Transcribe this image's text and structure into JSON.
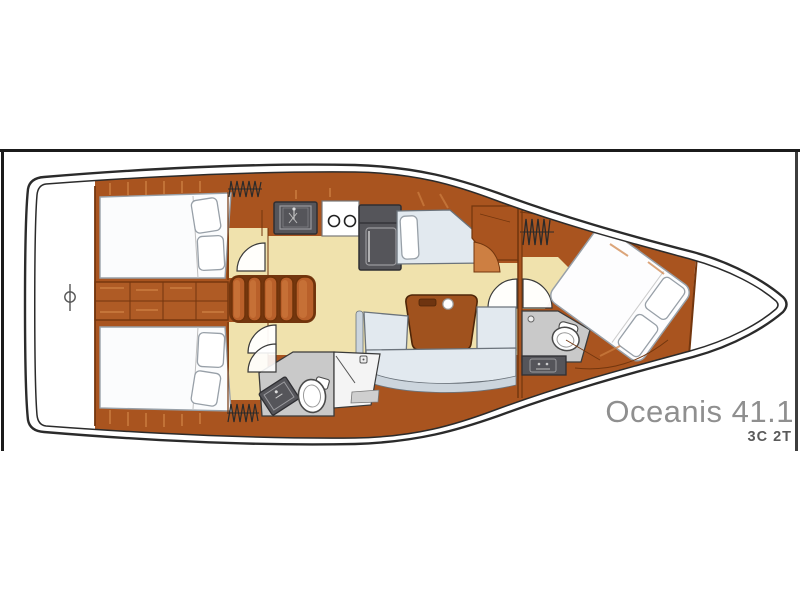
{
  "caption": {
    "title": "Oceanis 41.1",
    "variant": "3C 2T"
  },
  "colors": {
    "border": "#1b1b1b",
    "hullLine": "#2b2b2b",
    "wood": "#a9541f",
    "woodDark": "#73360e",
    "woodLight": "#cd7f42",
    "floor": "#f0e2ad",
    "gray": "#55555a",
    "grayDark": "#2f2f33",
    "grayLine": "#9a9a9e",
    "headFloor": "#c9c9c9",
    "settee": "#e2e9ef",
    "setteeBack": "#ccd5dd",
    "setteeLine": "#6b737b",
    "berth": "#fbfcfd",
    "berthLine": "#98a0a8",
    "table": "#a0521e",
    "title": "#8f8f8f",
    "subtitle": "#5a5a5a"
  }
}
